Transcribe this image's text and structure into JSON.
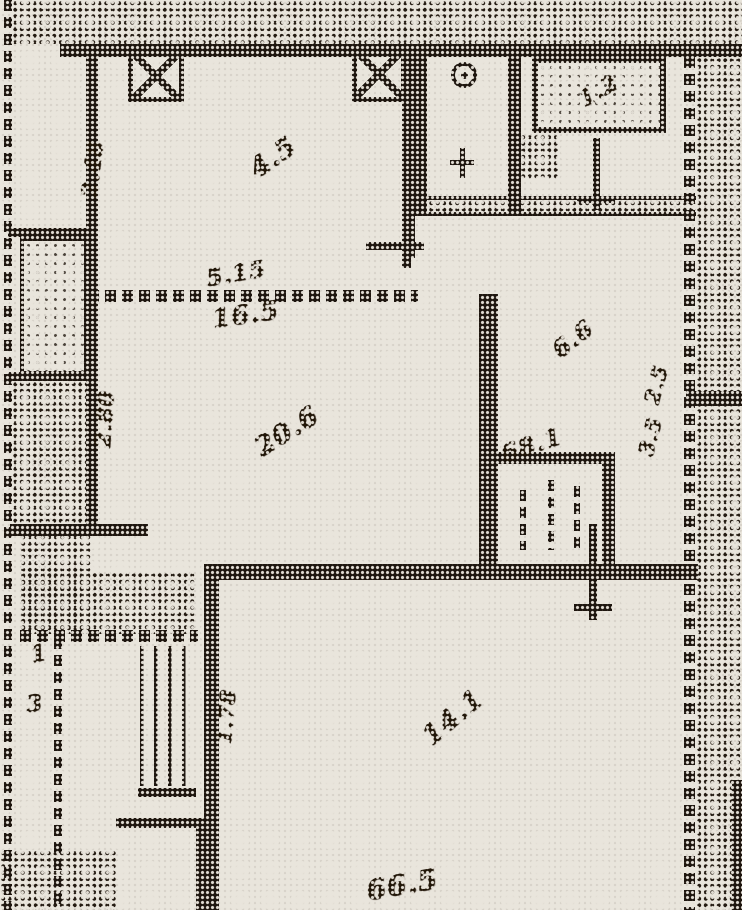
{
  "document": {
    "kind": "scanned floor plan (halftone print photo)"
  },
  "colors": {
    "paper": "#e9e5dc",
    "ink": "#1e160f"
  },
  "annotations": {
    "dim_top_left_vertical": {
      "text": "2.48"
    },
    "room_top_left_area": {
      "text": "4.5"
    },
    "dim_mid_width": {
      "text": "5.15"
    },
    "room_mid_label": {
      "text": "16.5"
    },
    "dim_mid_left_vertical": {
      "text": "2.80"
    },
    "room_mid_area": {
      "text": "20.6"
    },
    "hall_area": {
      "text": "6.6"
    },
    "closet_area": {
      "text": "68.1"
    },
    "dim_right_upper": {
      "text": "2.5"
    },
    "dim_right_lower": {
      "text": "3.5"
    },
    "kitchen_fixture_dim": {
      "text": "1.2"
    },
    "dim_bottom_left_vertical": {
      "text": "1.78"
    },
    "mark_left_upper": {
      "text": "1"
    },
    "mark_left_lower": {
      "text": "3"
    },
    "room_bottom_area": {
      "text": "14.1"
    },
    "dim_bottom_edge": {
      "text": "66.5"
    }
  }
}
